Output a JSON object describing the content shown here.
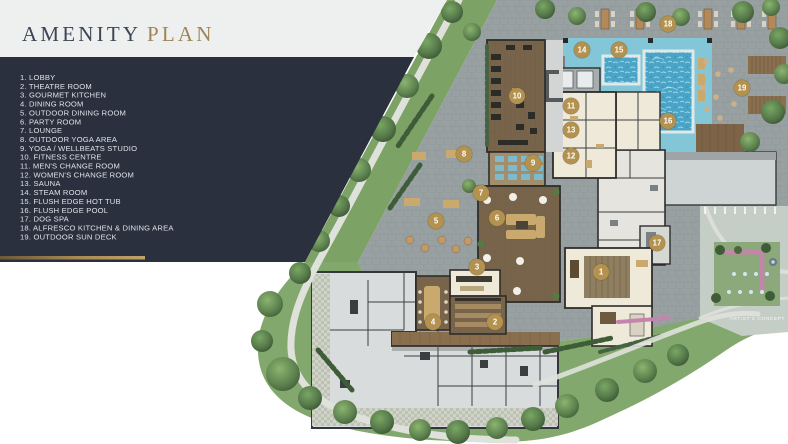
{
  "title": {
    "word1": "AMENITY",
    "word2": "PLAN"
  },
  "legend": {
    "items": [
      "1. LOBBY",
      "2. THEATRE ROOM",
      "3. GOURMET KITCHEN",
      "4. DINING ROOM",
      "5. OUTDOOR DINING ROOM",
      "6. PARTY ROOM",
      "7. LOUNGE",
      "8. OUTDOOR YOGA AREA",
      "9. YOGA / WELLBEATS STUDIO",
      "10. FITNESS CENTRE",
      "11. MEN'S CHANGE ROOM",
      "12. WOMEN'S CHANGE ROOM",
      "13. SAUNA",
      "14. STEAM ROOM",
      "15. FLUSH EDGE HOT TUB",
      "16. FLUSH EDGE POOL",
      "17. DOG SPA",
      "18. ALFRESCO KITCHEN & DINING AREA",
      "19. OUTDOOR SUN DECK"
    ]
  },
  "plan": {
    "caption": "ARTIST'S CONCEPT",
    "markers": [
      {
        "n": "1",
        "x": 601,
        "y": 272
      },
      {
        "n": "2",
        "x": 495,
        "y": 322
      },
      {
        "n": "3",
        "x": 477,
        "y": 267
      },
      {
        "n": "4",
        "x": 433,
        "y": 322
      },
      {
        "n": "5",
        "x": 436,
        "y": 221
      },
      {
        "n": "6",
        "x": 497,
        "y": 218
      },
      {
        "n": "7",
        "x": 481,
        "y": 193
      },
      {
        "n": "8",
        "x": 464,
        "y": 154
      },
      {
        "n": "9",
        "x": 533,
        "y": 163
      },
      {
        "n": "10",
        "x": 517,
        "y": 96
      },
      {
        "n": "11",
        "x": 571,
        "y": 106
      },
      {
        "n": "12",
        "x": 571,
        "y": 156
      },
      {
        "n": "13",
        "x": 571,
        "y": 130
      },
      {
        "n": "14",
        "x": 582,
        "y": 50
      },
      {
        "n": "15",
        "x": 619,
        "y": 50
      },
      {
        "n": "16",
        "x": 668,
        "y": 121
      },
      {
        "n": "17",
        "x": 657,
        "y": 243
      },
      {
        "n": "18",
        "x": 668,
        "y": 24
      },
      {
        "n": "19",
        "x": 742,
        "y": 88
      }
    ]
  },
  "colors": {
    "panel": "#2a303d",
    "header_band": "#eef0f0",
    "title_dark": "#3d4654",
    "title_gold": "#a08457",
    "legend_text": "#dfe3e8",
    "gold_accent": "#a98b55",
    "marker": "#b3914f",
    "lawn": "#82a86d",
    "band_green": "#7ca266",
    "pavement": "#98a0a1",
    "deck_aqua": "#82c6d8",
    "pool_water": "#49a4c6",
    "wood_floor": "#77644a",
    "cream_room": "#efe9da",
    "room_gray": "#e6e4de",
    "wall": "#2d2d2b",
    "drive": "#c5cdc7",
    "roof": "#ced3d4",
    "tan": "#c9a96e",
    "mat_blue": "#7fb9cc",
    "path": "#dfe2da",
    "pink_flowers": "#c583ad",
    "white_bg": "#ffffff"
  }
}
